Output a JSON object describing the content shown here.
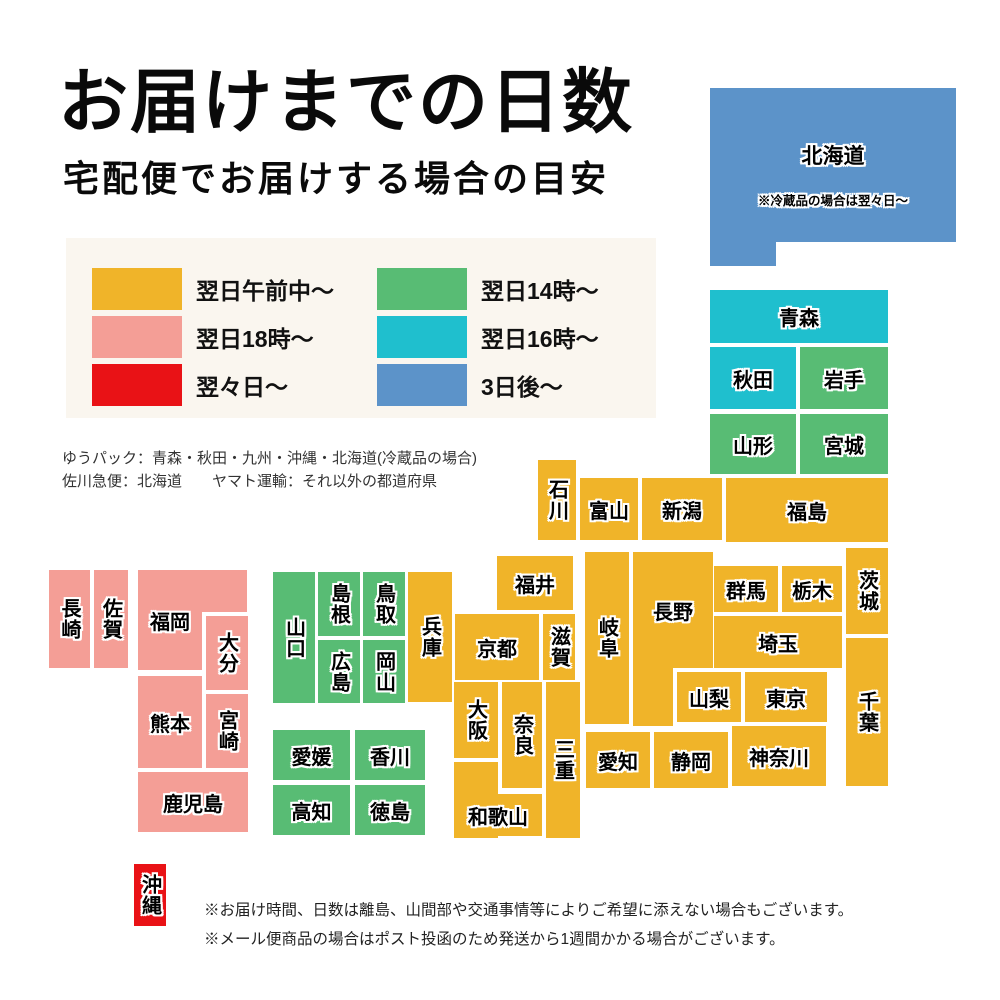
{
  "title": "お届けまでの日数",
  "subtitle": "宅配便でお届けする場合の目安",
  "palette": {
    "next_morning": "#F0B429",
    "next_18": "#F49E96",
    "two_days": "#E91216",
    "next_14": "#58BC74",
    "next_16": "#1FBFCE",
    "three_days": "#5C93C9",
    "legend_bg": "#FAF6EF"
  },
  "legend": {
    "items": [
      {
        "label": "翌日午前中〜",
        "color_key": "next_morning"
      },
      {
        "label": "翌日18時〜",
        "color_key": "next_18"
      },
      {
        "label": "翌々日〜",
        "color_key": "two_days"
      },
      {
        "label": "翌日14時〜",
        "color_key": "next_14"
      },
      {
        "label": "翌日16時〜",
        "color_key": "next_16"
      },
      {
        "label": "3日後〜",
        "color_key": "three_days"
      }
    ]
  },
  "courier_notes": [
    "ゆうパック：青森・秋田・九州・沖縄・北海道(冷蔵品の場合)",
    "佐川急便：北海道　　ヤマト運輸：それ以外の都道府県"
  ],
  "footnotes": [
    "※お届け時間、日数は離島、山間部や交通事情等によりご希望に添えない場合もございます。",
    "※メール便商品の場合はポスト投函のため発送から1週間かかる場合がございます。"
  ],
  "map": {
    "prefectures": [
      {
        "name": "北海道",
        "color_key": "three_days",
        "note": "※冷蔵品の場合は翌々日〜",
        "rects": [
          [
            710,
            88,
            246,
            154
          ],
          [
            710,
            242,
            66,
            24
          ]
        ]
      },
      {
        "name": "青森",
        "color_key": "next_16",
        "rects": [
          [
            710,
            290,
            178,
            53
          ]
        ]
      },
      {
        "name": "秋田",
        "color_key": "next_16",
        "rects": [
          [
            710,
            347,
            86,
            62
          ]
        ]
      },
      {
        "name": "岩手",
        "color_key": "next_14",
        "rects": [
          [
            800,
            347,
            88,
            62
          ]
        ]
      },
      {
        "name": "山形",
        "color_key": "next_14",
        "rects": [
          [
            710,
            414,
            86,
            60
          ]
        ]
      },
      {
        "name": "宮城",
        "color_key": "next_14",
        "rects": [
          [
            800,
            414,
            88,
            60
          ]
        ]
      },
      {
        "name": "石川",
        "color_key": "next_morning",
        "v": true,
        "rects": [
          [
            538,
            460,
            38,
            80
          ]
        ]
      },
      {
        "name": "富山",
        "color_key": "next_morning",
        "rects": [
          [
            580,
            478,
            58,
            62
          ]
        ]
      },
      {
        "name": "新潟",
        "color_key": "next_morning",
        "rects": [
          [
            642,
            478,
            80,
            62
          ]
        ]
      },
      {
        "name": "福島",
        "color_key": "next_morning",
        "rects": [
          [
            726,
            478,
            162,
            64
          ]
        ]
      },
      {
        "name": "福井",
        "color_key": "next_morning",
        "rects": [
          [
            497,
            556,
            76,
            54
          ]
        ]
      },
      {
        "name": "群馬",
        "color_key": "next_morning",
        "rects": [
          [
            714,
            566,
            64,
            46
          ]
        ]
      },
      {
        "name": "栃木",
        "color_key": "next_morning",
        "rects": [
          [
            782,
            566,
            60,
            46
          ]
        ]
      },
      {
        "name": "茨城",
        "color_key": "next_morning",
        "v": true,
        "rects": [
          [
            846,
            548,
            42,
            86
          ]
        ]
      },
      {
        "name": "埼玉",
        "color_key": "next_morning",
        "rects": [
          [
            714,
            616,
            128,
            52
          ]
        ]
      },
      {
        "name": "岐阜",
        "color_key": "next_morning",
        "v": true,
        "rects": [
          [
            585,
            552,
            44,
            172
          ]
        ]
      },
      {
        "name": "長野",
        "color_key": "next_morning",
        "rects": [
          [
            633,
            552,
            80,
            116
          ],
          [
            633,
            668,
            40,
            58
          ]
        ]
      },
      {
        "name": "山梨",
        "color_key": "next_morning",
        "rects": [
          [
            677,
            672,
            64,
            50
          ]
        ]
      },
      {
        "name": "東京",
        "color_key": "next_morning",
        "rects": [
          [
            745,
            672,
            82,
            50
          ]
        ]
      },
      {
        "name": "千葉",
        "color_key": "next_morning",
        "v": true,
        "rects": [
          [
            846,
            638,
            42,
            148
          ]
        ]
      },
      {
        "name": "神奈川",
        "color_key": "next_morning",
        "rects": [
          [
            732,
            726,
            94,
            60
          ]
        ]
      },
      {
        "name": "静岡",
        "color_key": "next_morning",
        "rects": [
          [
            654,
            732,
            74,
            56
          ]
        ]
      },
      {
        "name": "愛知",
        "color_key": "next_morning",
        "rects": [
          [
            586,
            732,
            64,
            56
          ]
        ]
      },
      {
        "name": "京都",
        "color_key": "next_morning",
        "rects": [
          [
            455,
            614,
            84,
            66
          ]
        ]
      },
      {
        "name": "滋賀",
        "color_key": "next_morning",
        "v": true,
        "rects": [
          [
            543,
            614,
            32,
            66
          ]
        ]
      },
      {
        "name": "兵庫",
        "color_key": "next_morning",
        "v": true,
        "rects": [
          [
            408,
            572,
            44,
            130
          ]
        ]
      },
      {
        "name": "大阪",
        "color_key": "next_morning",
        "v": true,
        "rects": [
          [
            454,
            682,
            44,
            76
          ]
        ]
      },
      {
        "name": "奈良",
        "color_key": "next_morning",
        "v": true,
        "rects": [
          [
            502,
            682,
            40,
            106
          ]
        ]
      },
      {
        "name": "三重",
        "color_key": "next_morning",
        "v": true,
        "rects": [
          [
            546,
            682,
            34,
            156
          ]
        ]
      },
      {
        "name": "和歌山",
        "color_key": "next_morning",
        "rects": [
          [
            454,
            794,
            88,
            42
          ],
          [
            454,
            762,
            44,
            76
          ]
        ]
      },
      {
        "name": "山口",
        "color_key": "next_14",
        "v": true,
        "rects": [
          [
            273,
            572,
            42,
            131
          ]
        ]
      },
      {
        "name": "島根",
        "color_key": "next_14",
        "v": true,
        "rects": [
          [
            318,
            572,
            42,
            64
          ]
        ]
      },
      {
        "name": "鳥取",
        "color_key": "next_14",
        "v": true,
        "rects": [
          [
            363,
            572,
            42,
            64
          ]
        ]
      },
      {
        "name": "広島",
        "color_key": "next_14",
        "v": true,
        "rects": [
          [
            318,
            640,
            42,
            63
          ]
        ]
      },
      {
        "name": "岡山",
        "color_key": "next_14",
        "v": true,
        "rects": [
          [
            363,
            640,
            42,
            63
          ]
        ]
      },
      {
        "name": "愛媛",
        "color_key": "next_14",
        "rects": [
          [
            273,
            730,
            77,
            50
          ]
        ]
      },
      {
        "name": "香川",
        "color_key": "next_14",
        "rects": [
          [
            355,
            730,
            70,
            50
          ]
        ]
      },
      {
        "name": "高知",
        "color_key": "next_14",
        "rects": [
          [
            273,
            785,
            77,
            50
          ]
        ]
      },
      {
        "name": "徳島",
        "color_key": "next_14",
        "rects": [
          [
            355,
            785,
            70,
            50
          ]
        ]
      },
      {
        "name": "長崎",
        "color_key": "next_18",
        "v": true,
        "rects": [
          [
            49,
            570,
            41,
            98
          ]
        ]
      },
      {
        "name": "佐賀",
        "color_key": "next_18",
        "v": true,
        "rects": [
          [
            94,
            570,
            34,
            98
          ]
        ]
      },
      {
        "name": "福岡",
        "color_key": "next_18",
        "rects": [
          [
            138,
            570,
            64,
            100
          ],
          [
            138,
            570,
            109,
            42
          ]
        ]
      },
      {
        "name": "大分",
        "color_key": "next_18",
        "v": true,
        "rects": [
          [
            206,
            616,
            42,
            74
          ]
        ]
      },
      {
        "name": "熊本",
        "color_key": "next_18",
        "rects": [
          [
            138,
            676,
            64,
            92
          ]
        ]
      },
      {
        "name": "宮崎",
        "color_key": "next_18",
        "v": true,
        "rects": [
          [
            206,
            694,
            42,
            74
          ]
        ]
      },
      {
        "name": "鹿児島",
        "color_key": "next_18",
        "rects": [
          [
            138,
            772,
            110,
            60
          ]
        ]
      },
      {
        "name": "沖縄",
        "color_key": "two_days",
        "v": true,
        "rects": [
          [
            134,
            864,
            32,
            62
          ]
        ]
      }
    ]
  }
}
